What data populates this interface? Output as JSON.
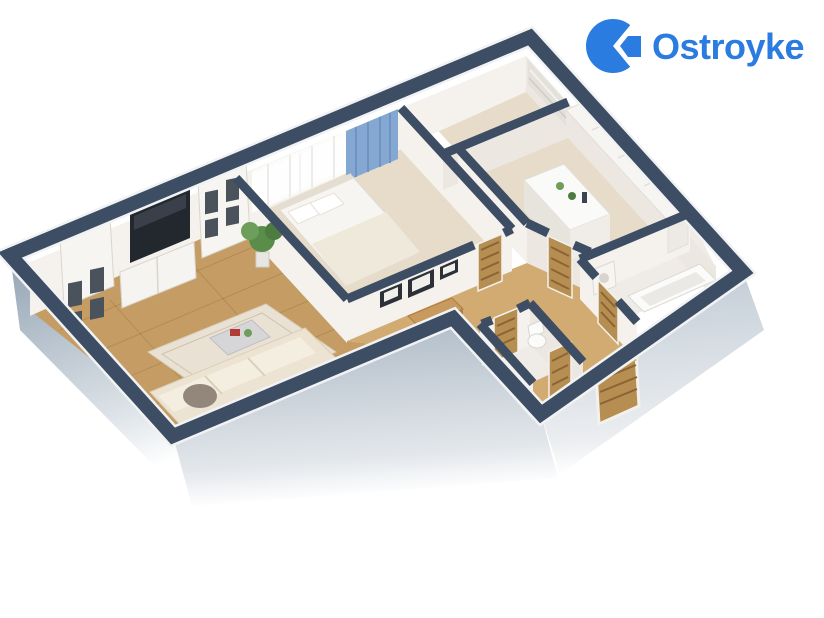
{
  "page": {
    "background": "#ffffff",
    "width": 824,
    "height": 618
  },
  "logo": {
    "text": "Ostroyke"
  },
  "colors": {
    "wall-top": "#3d4d63",
    "wall-face": "#f5f2ed",
    "exterior-dark": "#93a3b3",
    "exterior-mid": "#a9b6c3",
    "exterior-light": "#bfcad4",
    "floor-wood": "#c59d64",
    "floor-hall": "#d2ab72",
    "floor-light": "#e6dcc9",
    "curtain-blue": "#84a8d2",
    "sofa-cream": "#ece3d2",
    "door-wood": "#b68e52",
    "rug": "#e9e1d3",
    "accent-green": "#5a8c4a",
    "logo-blue": "#2b7ce0"
  },
  "scene": {
    "type": "3d-apartment-floor-plan",
    "view": "isometric-cutaway",
    "rooms": [
      {
        "name": "living-room",
        "floor": "wood",
        "furniture": [
          "bookcase-left",
          "tv-stand",
          "tv",
          "bookcase-right",
          "potted-plant",
          "rug",
          "coffee-table",
          "corner-sofa",
          "pouf"
        ]
      },
      {
        "name": "bedroom",
        "floor": "wood",
        "furniture": [
          "double-bed",
          "pillows",
          "sheer-curtain",
          "blue-curtain",
          "wall-frames",
          "door"
        ]
      },
      {
        "name": "balcony",
        "floor": "wood",
        "furniture": [
          "window-shade"
        ]
      },
      {
        "name": "kitchen",
        "floor": "wood",
        "furniture": [
          "wall-cabinets",
          "island-counter",
          "door"
        ]
      },
      {
        "name": "bathroom",
        "floor": "tile",
        "furniture": [
          "bathtub",
          "washing-machine",
          "door"
        ]
      },
      {
        "name": "wc",
        "floor": "tile",
        "furniture": [
          "toilet",
          "door"
        ]
      },
      {
        "name": "hallway",
        "floor": "wood",
        "furniture": [
          "console-table",
          "interior-doors",
          "entrance-door"
        ]
      }
    ]
  }
}
